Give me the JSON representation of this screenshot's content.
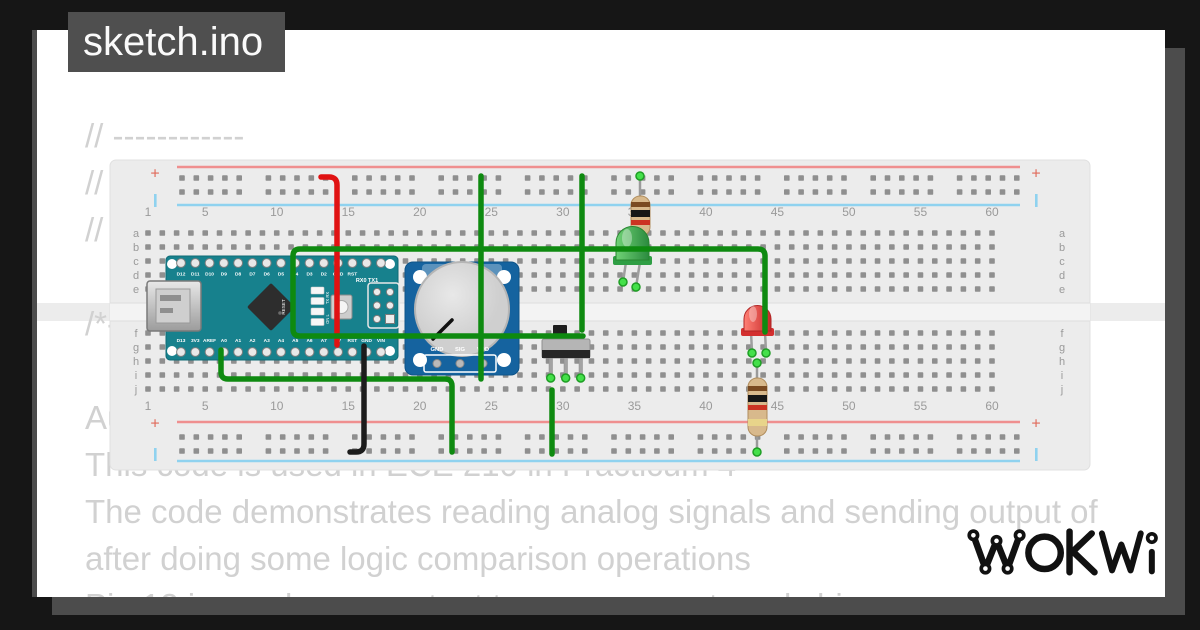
{
  "frame": {
    "title": "sketch.ino"
  },
  "code": {
    "lines": [
      "// ------------",
      "// E",
      "// -",
      "",
      "/*--",
      "",
      "Au",
      "This code is used in ECE 210 in Practicum 4",
      "The code demonstrates reading analog signals and sending output of",
      "after doing some logic comparison operations",
      "Pin 12 is used as an output to power an external chip"
    ]
  },
  "logo": {
    "text": "WOKWi"
  },
  "breadboard": {
    "column_numbers": [
      "1",
      "5",
      "10",
      "15",
      "20",
      "25",
      "30",
      "35",
      "40",
      "45",
      "50",
      "55",
      "60"
    ],
    "row_letters_upper": [
      "a",
      "b",
      "c",
      "d",
      "e"
    ],
    "row_letters_lower": [
      "f",
      "g",
      "h",
      "i",
      "j"
    ],
    "positive_marker": "+"
  },
  "arduino_nano": {
    "top_pin_labels": [
      "D12",
      "D11",
      "D10",
      "D9",
      "D8",
      "D7",
      "D6",
      "D5",
      "D4",
      "D3",
      "D2",
      "GND",
      "RST"
    ],
    "serial_labels": "RX0 TX1",
    "bottom_pin_labels": [
      "D13",
      "3V3",
      "AREF",
      "A0",
      "A1",
      "A2",
      "A3",
      "A4",
      "A5",
      "A6",
      "A7",
      "5V",
      "RST",
      "GND",
      "VIN"
    ],
    "reset_label": "RESET",
    "led_labels_1": "TX RX",
    "led_labels_2": "ON L"
  },
  "potentiometer": {
    "pin_labels": [
      "GND",
      "SIG",
      "VDD"
    ]
  },
  "colors": {
    "wire_red": "#e01212",
    "wire_green": "#0e8a10",
    "wire_black": "#1c1c1c",
    "wire_end_dot": "#44e04a",
    "nano_board": "#17818d",
    "pot_board": "#15639f",
    "led_green": "#2f9e44",
    "led_red": "#d32f2f",
    "rail_positive": "#ef8f8f",
    "rail_negative": "#8fd2ef",
    "breadboard": "#ececec",
    "hole": "#8f8f8f"
  }
}
